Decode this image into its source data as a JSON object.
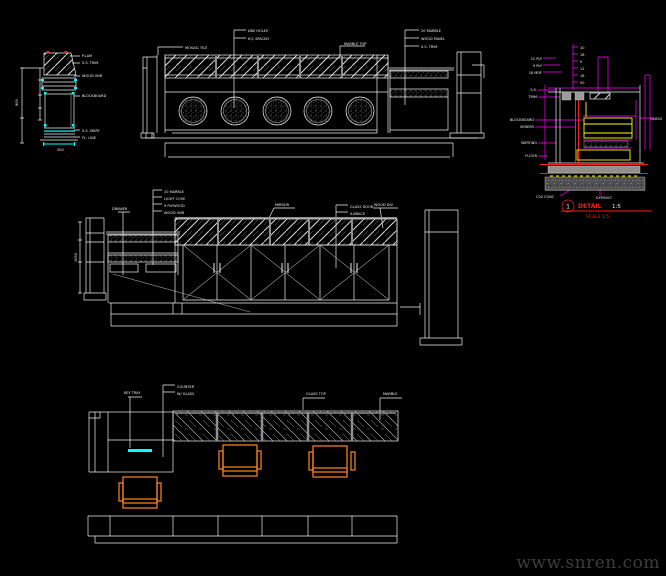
{
  "colors": {
    "white": "#f0f0f0",
    "cyan": "#00ffff",
    "magenta": "#ff00ff",
    "red": "#ff1a1a",
    "yellow": "#ffff00",
    "orange": "#f07d1a",
    "gray": "#8f8f8f",
    "watermark_gray": "#3d3d3d"
  },
  "watermark": {
    "text": "www.snren.com"
  },
  "detail_title": {
    "number": "1",
    "label": "DETAIL",
    "scale": "1:5",
    "subtitle": "SCALE 1:5"
  },
  "annotations": [
    {
      "x": 82,
      "y": 57,
      "text": "P.LAM"
    },
    {
      "x": 82,
      "y": 64,
      "text": "S.S. TRIM"
    },
    {
      "x": 82,
      "y": 77,
      "text": "WOOD VNR"
    },
    {
      "x": 82,
      "y": 97,
      "text": "BLOCKBOARD"
    },
    {
      "x": 82,
      "y": 132,
      "text": "S.S. SKIRT"
    },
    {
      "x": 82,
      "y": 139,
      "text": "FL. LINE"
    },
    {
      "x": 57,
      "y": 151,
      "text": "500"
    },
    {
      "x": 18,
      "y": 106,
      "text": "900",
      "rotate": -90
    },
    {
      "x": 185,
      "y": 49,
      "text": "MOSAIC TILE"
    },
    {
      "x": 248,
      "y": 32,
      "text": "Ø80 HOLES"
    },
    {
      "x": 248,
      "y": 40,
      "text": "EQ. SPACED"
    },
    {
      "x": 344,
      "y": 45,
      "text": "MARBLE TOP"
    },
    {
      "x": 421,
      "y": 32,
      "text": "20 MARBLE"
    },
    {
      "x": 421,
      "y": 40,
      "text": "WOOD PANEL"
    },
    {
      "x": 421,
      "y": 48,
      "text": "S.S. TRIM"
    },
    {
      "x": 164,
      "y": 193,
      "text": "20 MARBLE"
    },
    {
      "x": 164,
      "y": 200,
      "text": "LIGHT COVE"
    },
    {
      "x": 164,
      "y": 207,
      "text": "9 PLYWOOD"
    },
    {
      "x": 164,
      "y": 214,
      "text": "WOOD VNR"
    },
    {
      "x": 112,
      "y": 210,
      "text": "DRAWER"
    },
    {
      "x": 275,
      "y": 206,
      "text": "MIRROR"
    },
    {
      "x": 350,
      "y": 208,
      "text": "GLASS DOOR"
    },
    {
      "x": 350,
      "y": 215,
      "text": "X-BRACE"
    },
    {
      "x": 374,
      "y": 206,
      "text": "WOOD DIV."
    },
    {
      "x": 77,
      "y": 262,
      "text": "1050",
      "rotate": -90
    },
    {
      "x": 177,
      "y": 388,
      "text": "COUNTER"
    },
    {
      "x": 177,
      "y": 395,
      "text": "W/ GLASS"
    },
    {
      "x": 124,
      "y": 394,
      "text": "KEY TRAY"
    },
    {
      "x": 306,
      "y": 395,
      "text": "GLASS TOP"
    },
    {
      "x": 383,
      "y": 395,
      "text": "MARBLE"
    },
    {
      "x": 580,
      "y": 49,
      "text": "10"
    },
    {
      "x": 580,
      "y": 56,
      "text": "18"
    },
    {
      "x": 580,
      "y": 63,
      "text": "9"
    },
    {
      "x": 580,
      "y": 70,
      "text": "12"
    },
    {
      "x": 580,
      "y": 77,
      "text": "18"
    },
    {
      "x": 580,
      "y": 84,
      "text": "50"
    },
    {
      "x": 542,
      "y": 60,
      "text": "12 PLY",
      "anchor": "end"
    },
    {
      "x": 542,
      "y": 67,
      "text": "9 PLY",
      "anchor": "end"
    },
    {
      "x": 542,
      "y": 74,
      "text": "18 MDF",
      "anchor": "end"
    },
    {
      "x": 537,
      "y": 91,
      "text": "S.S.",
      "anchor": "end"
    },
    {
      "x": 537,
      "y": 98,
      "text": "TRIM",
      "anchor": "end"
    },
    {
      "x": 534,
      "y": 121,
      "text": "BLOCKBOARD",
      "anchor": "end"
    },
    {
      "x": 534,
      "y": 128,
      "text": "VENEER",
      "anchor": "end"
    },
    {
      "x": 537,
      "y": 144,
      "text": "SKIRTING",
      "anchor": "end"
    },
    {
      "x": 537,
      "y": 157,
      "text": "FLOOR",
      "anchor": "end"
    },
    {
      "x": 662,
      "y": 120,
      "text": "GLASS",
      "anchor": "end"
    },
    {
      "x": 536,
      "y": 198,
      "text": "C20 CONC"
    },
    {
      "x": 596,
      "y": 199,
      "text": "EXP.BOLT"
    }
  ]
}
